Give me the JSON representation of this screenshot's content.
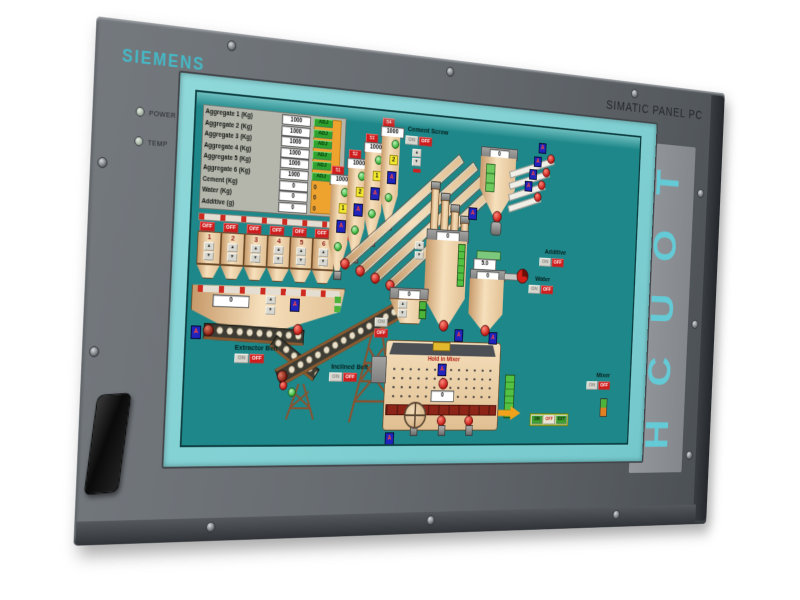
{
  "device": {
    "brand": "SIEMENS",
    "model": "SIMATIC PANEL PC",
    "touch_letters": [
      "T",
      "O",
      "U",
      "C",
      "H"
    ],
    "led_power": "POWER",
    "led_temp": "TEMP"
  },
  "colors": {
    "siemens_teal": "#45b9c6",
    "bezel_gray": "#666b70",
    "screen_bezel_turquoise": "#7fd0d3",
    "screen_teal": "#1e8789",
    "equipment_tan": "#eed4aa",
    "alarm_red": "#cf1d1d",
    "ok_green": "#2fa32f",
    "warn_orange": "#efa32f"
  },
  "icons": {
    "up": "▲",
    "down": "▼",
    "valve": "A"
  },
  "table": {
    "rows": [
      {
        "label": "Aggregate 1 (Kg)",
        "value": "1000",
        "adj": "ADJ"
      },
      {
        "label": "Aggregate 2 (Kg)",
        "value": "1000",
        "adj": "ADJ"
      },
      {
        "label": "Aggregate 3 (Kg)",
        "value": "1000",
        "adj": "ADJ"
      },
      {
        "label": "Aggregate 4 (Kg)",
        "value": "1000",
        "adj": "ADJ"
      },
      {
        "label": "Aggregate 5 (Kg)",
        "value": "1000",
        "adj": "ADJ"
      },
      {
        "label": "Aggregate 6 (Kg)",
        "value": "1000",
        "adj": "ADJ"
      },
      {
        "label": "Cement (Kg)",
        "value": "0",
        "right": "0"
      },
      {
        "label": "Water (Kg)",
        "value": "0",
        "right": "0"
      },
      {
        "label": "Additive (g)",
        "value": "0",
        "right": "0"
      }
    ]
  },
  "silos": {
    "tags": [
      "51",
      "52",
      "53",
      "54"
    ],
    "values": [
      "1000",
      "1000",
      "1000",
      "1000"
    ],
    "outlets": [
      "1",
      "2",
      "1",
      "2"
    ]
  },
  "bins": {
    "numbers": [
      "1",
      "2",
      "3",
      "4",
      "5",
      "6"
    ],
    "off": "OFF"
  },
  "groups": {
    "cement_screw": {
      "label": "Cement Screw",
      "on": "ON",
      "off": "OFF"
    },
    "additive": {
      "label": "Additive",
      "on": "ON",
      "off": "OFF",
      "value": "0"
    },
    "water": {
      "label": "Water",
      "on": "ON",
      "off": "OFF",
      "setpoint": "5.0",
      "actual": "0"
    },
    "mixer": {
      "label": "Mixer",
      "on": "ON",
      "off": "OFF",
      "hold": "Hold in Mixer",
      "value": "0",
      "mode": [
        "ON",
        "OFF",
        "EXT"
      ]
    },
    "extractor": {
      "label": "Extractor Belt",
      "on": "ON",
      "off": "OFF",
      "value": "0"
    },
    "inclined": {
      "label": "Inclined Belt",
      "on": "ON",
      "off": "OFF"
    },
    "transfer": {
      "on": "ON",
      "off": "OFF",
      "value": "0"
    },
    "cement_weigher": {
      "value": "0"
    }
  }
}
